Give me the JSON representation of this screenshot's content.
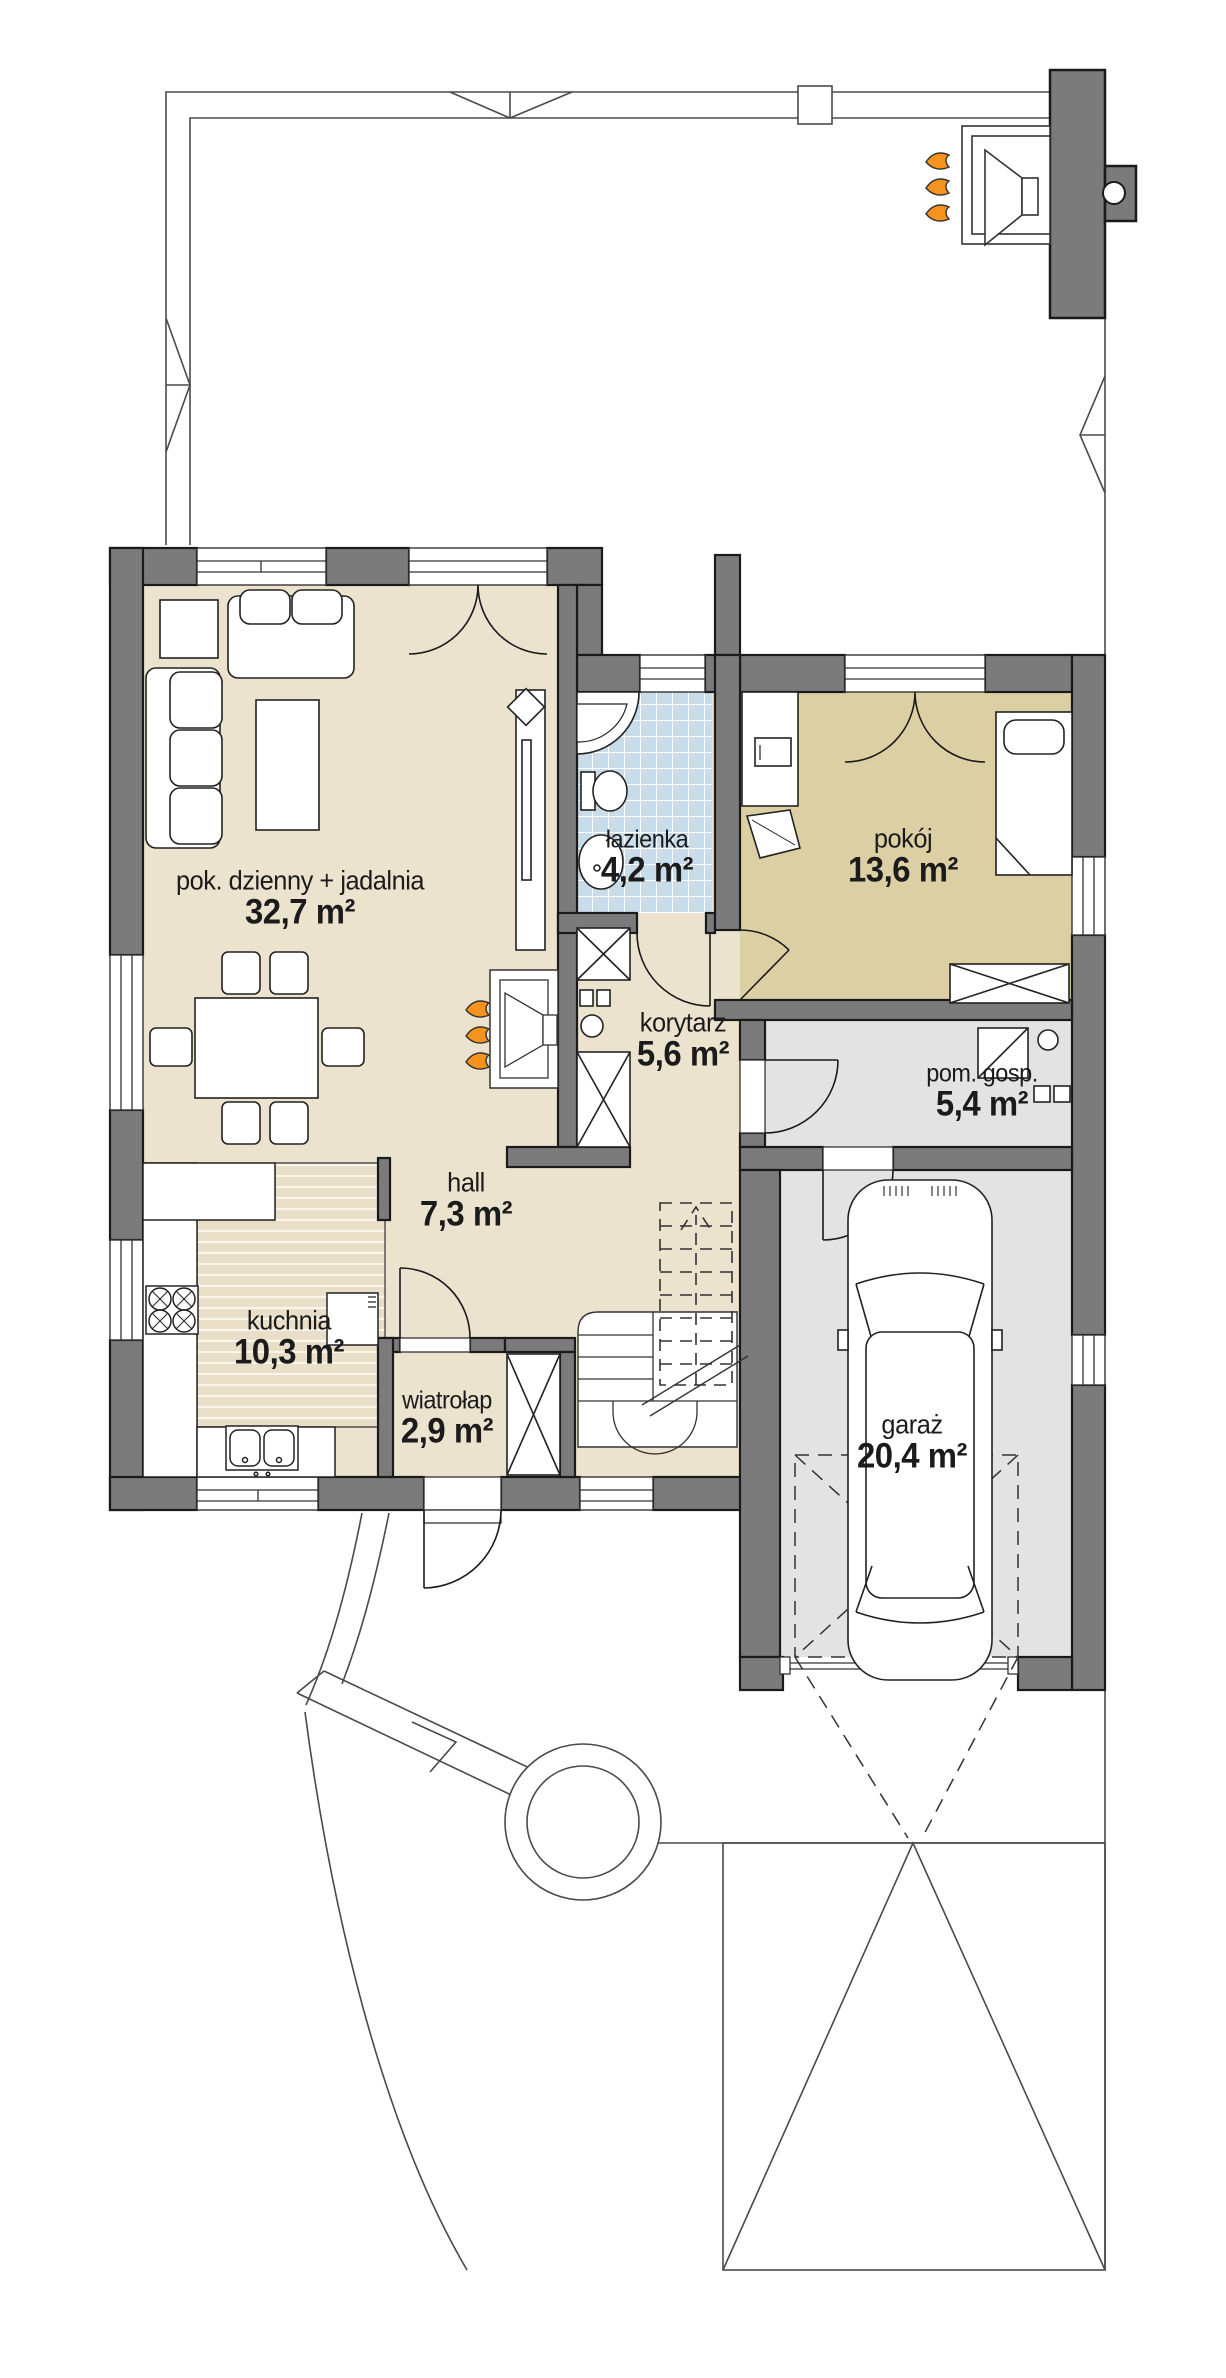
{
  "plan_title": "rzut parteru domu jednorodzinnego",
  "rooms": [
    {
      "id": "pok-dzienny",
      "name": "pok. dzienny + jadalnia",
      "area": "32,7 m²"
    },
    {
      "id": "lazienka",
      "name": "łazienka",
      "area": "4,2 m²"
    },
    {
      "id": "pokoj",
      "name": "pokój",
      "area": "13,6 m²"
    },
    {
      "id": "korytarz",
      "name": "korytarz",
      "area": "5,6 m²"
    },
    {
      "id": "pom-gosp",
      "name": "pom. gosp.",
      "area": "5,4 m²"
    },
    {
      "id": "hall",
      "name": "hall",
      "area": "7,3 m²"
    },
    {
      "id": "kuchnia",
      "name": "kuchnia",
      "area": "10,3 m²"
    },
    {
      "id": "wiatrolap",
      "name": "wiatrołap",
      "area": "2,9 m²"
    },
    {
      "id": "garaz",
      "name": "garaż",
      "area": "20,4 m²"
    }
  ],
  "icons": {
    "fireplace": "flame-icon",
    "grill": "grill-icon",
    "car": "car-icon",
    "staircase": "staircase-icon",
    "well": "well-icon"
  },
  "colors": {
    "wall": "#7b7b7b",
    "wall_outline": "#1a1a1a",
    "floor_beige": "#ece3cf",
    "floor_tan": "#ddcfa4",
    "floor_gray": "#e3e3e3",
    "tile_blue": "#c9dcea",
    "flame_orange": "#f6921e",
    "thin_line": "#4a4a4a",
    "label_text": "#1b1b1b"
  }
}
